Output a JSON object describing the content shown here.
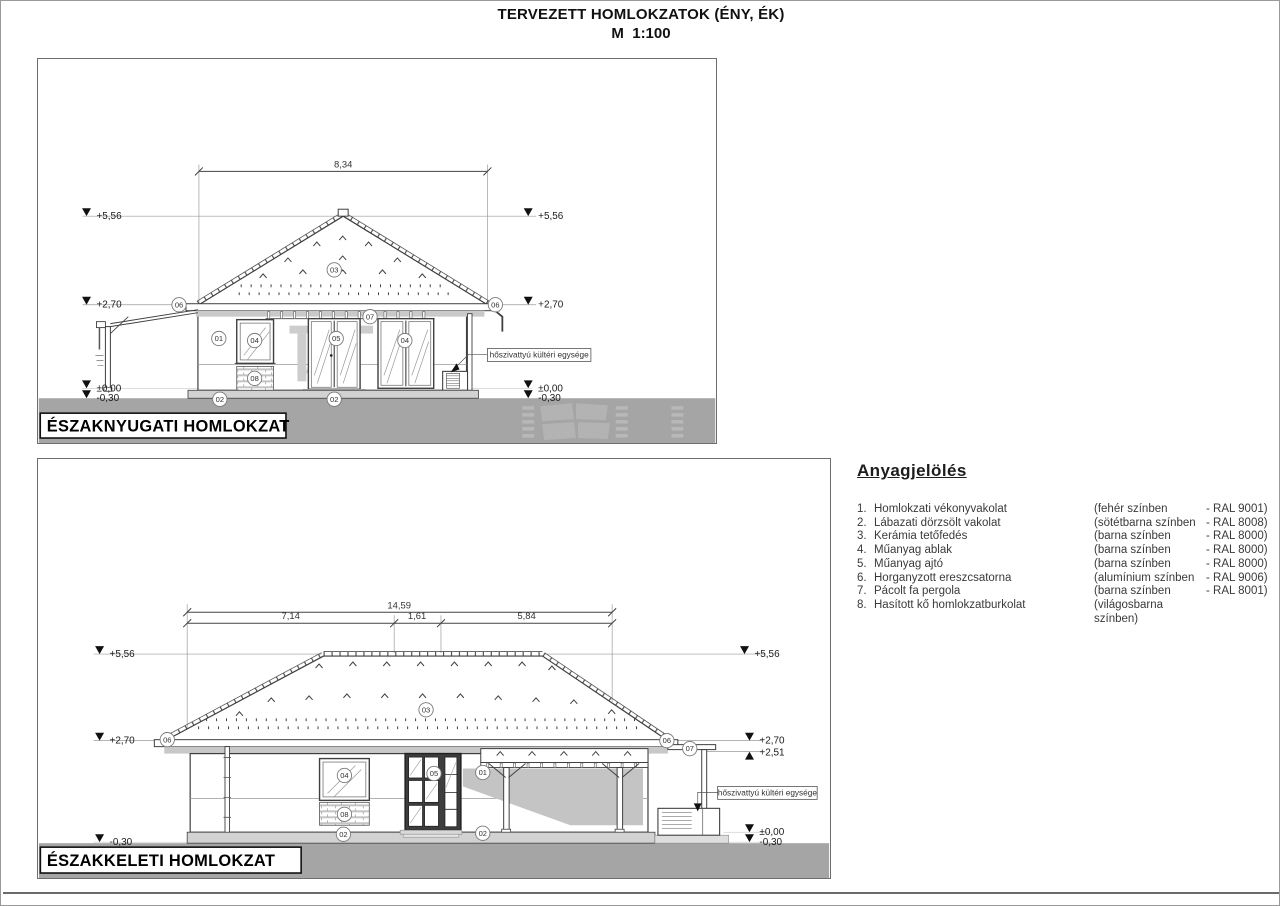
{
  "page": {
    "title": "TERVEZETT HOMLOKZATOK (ÉNY, ÉK)",
    "scale": "M  1:100"
  },
  "elev1": {
    "name": "ÉSZAKNYUGATI HOMLOKZAT",
    "dim_total": "8,34",
    "lv_556": "+5,56",
    "lv_270": "+2,70",
    "lv_000": "±0,00",
    "lv_030": "-0,30",
    "heat_pump": "hőszivattyú kültéri egysége",
    "callouts": {
      "c01": "01",
      "c02": "02",
      "c03": "03",
      "c04": "04",
      "c05": "05",
      "c06": "06",
      "c07": "07",
      "c08": "08"
    }
  },
  "elev2": {
    "name": "ÉSZAKKELETI HOMLOKZAT",
    "dim_total": "14,59",
    "dim_left": "7,14",
    "dim_mid": "1,61",
    "dim_right": "5,84",
    "lv_556": "+5,56",
    "lv_270": "+2,70",
    "lv_251": "+2,51",
    "lv_000": "±0,00",
    "lv_030": "-0,30",
    "heat_pump": "hőszivattyú kültéri egysége",
    "callouts": {
      "c01": "01",
      "c02": "02",
      "c03": "03",
      "c04": "04",
      "c05": "05",
      "c06": "06",
      "c07": "07",
      "c08": "08"
    }
  },
  "legend": {
    "title": "Anyagjelölés",
    "items": [
      {
        "num": "1.",
        "name": "Homlokzati vékonyvakolat",
        "color": "(fehér színben",
        "ral": "- RAL 9001)"
      },
      {
        "num": "2.",
        "name": "Lábazati dörzsölt vakolat",
        "color": "(sötétbarna színben",
        "ral": "- RAL 8008)"
      },
      {
        "num": "3.",
        "name": "Kerámia tetőfedés",
        "color": "(barna színben",
        "ral": "- RAL 8000)"
      },
      {
        "num": "4.",
        "name": "Műanyag ablak",
        "color": "(barna színben",
        "ral": "- RAL 8000)"
      },
      {
        "num": "5.",
        "name": "Műanyag ajtó",
        "color": "(barna színben",
        "ral": "- RAL 8000)"
      },
      {
        "num": "6.",
        "name": "Horganyzott ereszcsatorna",
        "color": "(alumínium színben",
        "ral": "- RAL 9006)"
      },
      {
        "num": "7.",
        "name": "Pácolt fa pergola",
        "color": "(barna színben",
        "ral": "- RAL 8001)"
      },
      {
        "num": "8.",
        "name": "Hasított kő homlokzatburkolat",
        "color": "(világosbarna színben)",
        "ral": ""
      }
    ]
  }
}
